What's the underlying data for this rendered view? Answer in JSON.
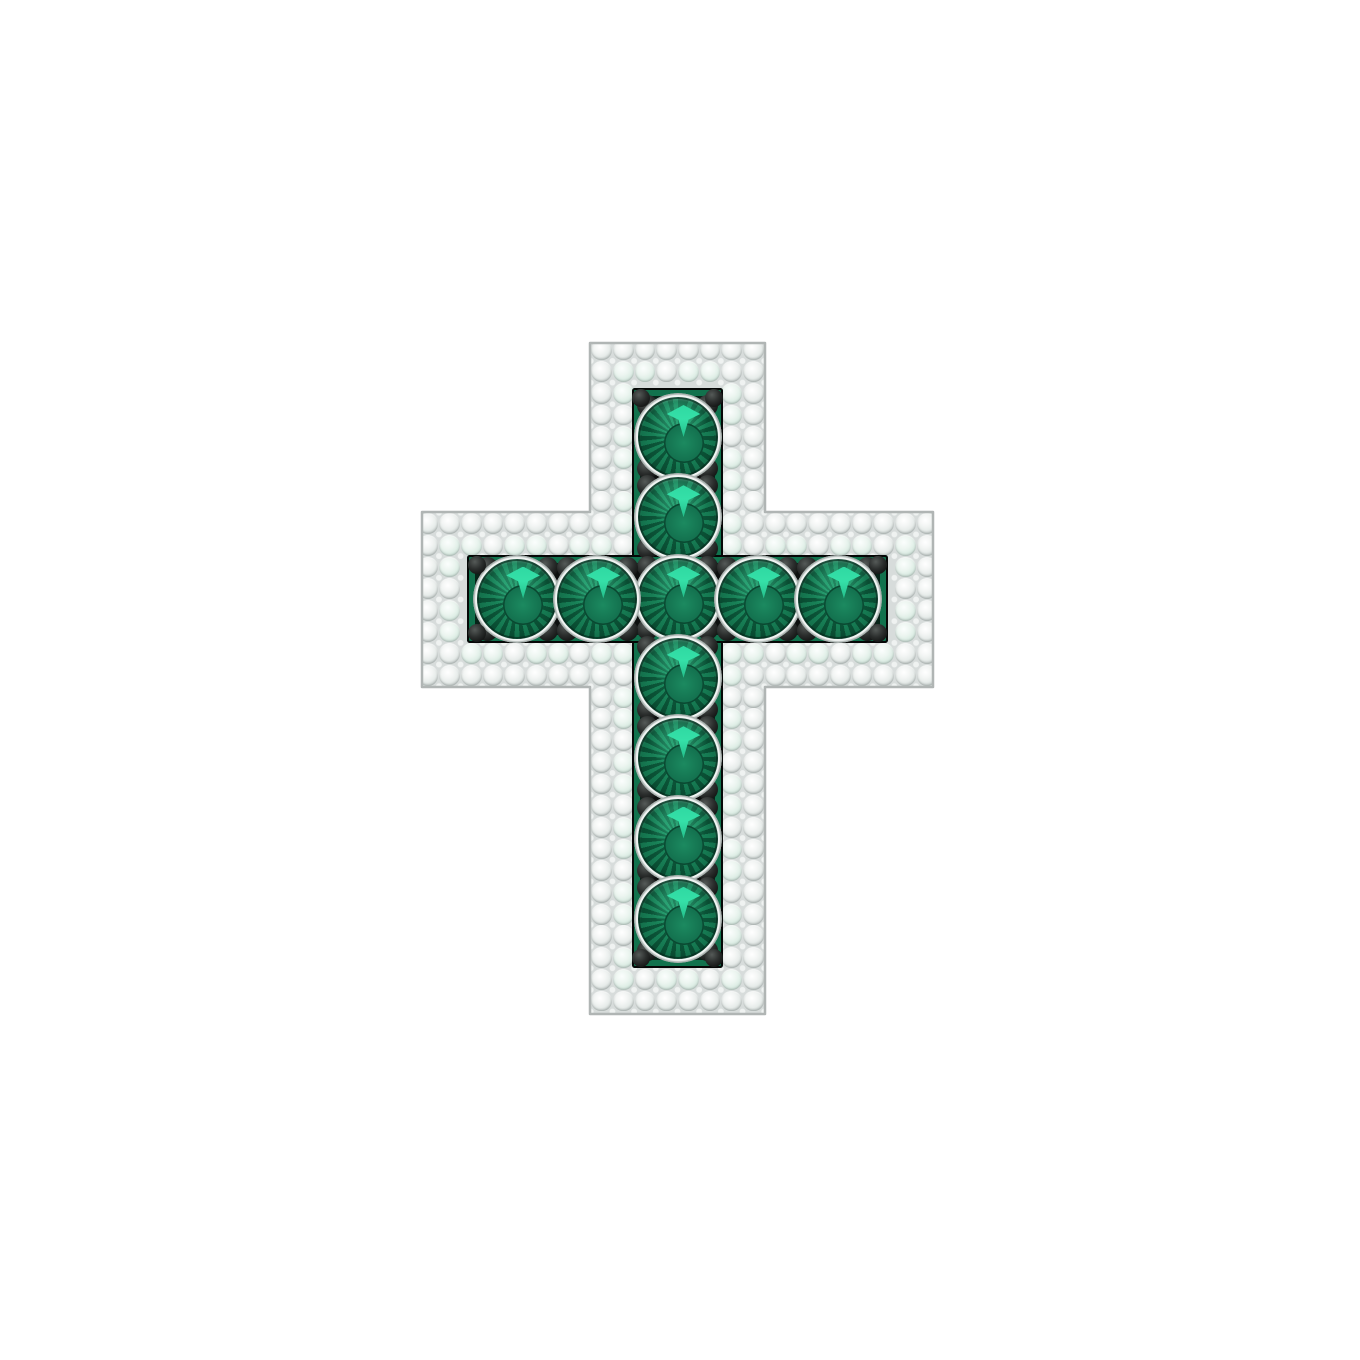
{
  "image": {
    "description": "Product render of a cross pendant with a pave white-diamond border, channel-set round emeralds and black prong accents, on a white background",
    "background_color": "#ffffff"
  },
  "pendant": {
    "stone_counts": {
      "emeralds": 11,
      "emeralds_vertical": 7,
      "emeralds_horizontal": 5
    },
    "colors": {
      "background_color": "#ffffff",
      "metal_gap_color": "#d7dcdb",
      "bead_color": "#eff2f1",
      "metal_edge_color": "#b0b5b4",
      "pave_diamond_color": "#f4f6f5",
      "pave_diamond_edge": "#c6cdcb",
      "pave_green_tint": "#d9ebe2",
      "emerald_body": "#157a52",
      "emerald_light": "#1d9066",
      "emerald_dark": "#07432c",
      "emerald_highlight": "#2fd9a2",
      "channel_color": "#0d100f",
      "channel_green": "#11724d",
      "prong_color": "#161817"
    },
    "geometry": {
      "vbar": {
        "x": 590,
        "y": 343,
        "w": 175,
        "h": 671
      },
      "hbar": {
        "x": 422,
        "y": 512,
        "w": 511,
        "h": 175
      },
      "vchannel": {
        "x": 632,
        "y": 388,
        "w": 91,
        "h": 580
      },
      "hchannel": {
        "x": 467,
        "y": 555,
        "w": 421,
        "h": 88
      },
      "outline_path": "M590,343 L765,343 L765,512 L933,512 L933,687 L765,687 L765,1014 L590,1014 L590,687 L422,687 L422,512 L590,512 Z",
      "pave_spacing": 21.7,
      "pave_radius": 10.4,
      "emerald_radius": 40,
      "vertical_column_x": 677.5,
      "vertical_stone_y": [
        437,
        517.3,
        597.6,
        677.9,
        758.2,
        838.5,
        918.8
      ],
      "horizontal_row_y": 598.5,
      "horizontal_stone_x": [
        517.1,
        597.3,
        757.7,
        837.9
      ],
      "prong_offset": {
        "dx": 30,
        "dy": 31.5,
        "r": 10.5
      },
      "end_prongs": [
        [
          641,
          398
        ],
        [
          714,
          398
        ],
        [
          641,
          958
        ],
        [
          714,
          958
        ],
        [
          477,
          565
        ],
        [
          477,
          633
        ],
        [
          878,
          565
        ],
        [
          878,
          633
        ]
      ],
      "end_prong_r": 9
    }
  }
}
